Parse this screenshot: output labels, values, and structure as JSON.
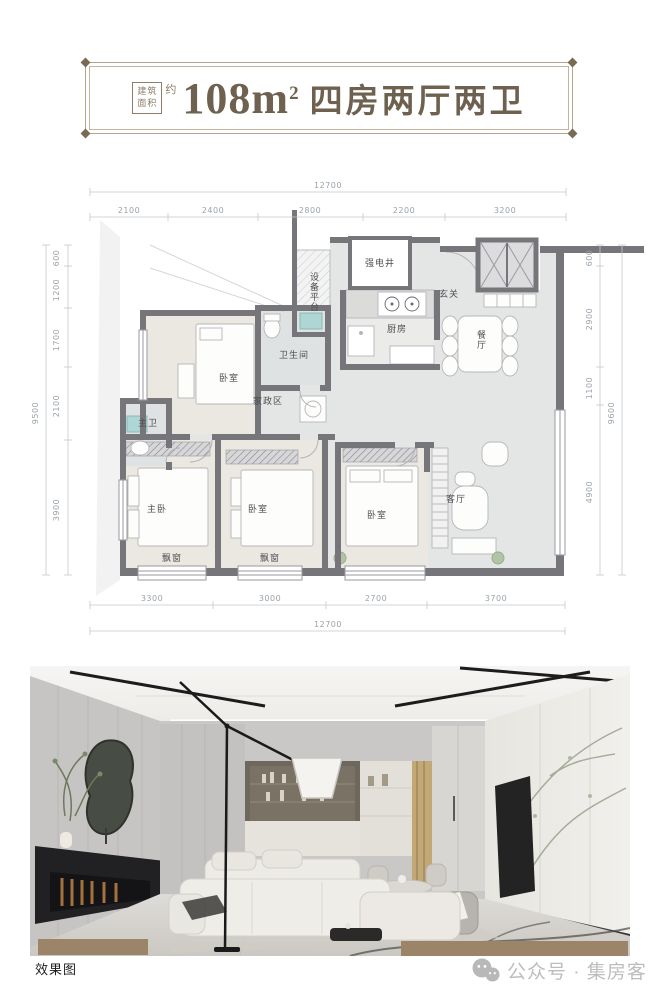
{
  "banner": {
    "area_tag_top": "建筑",
    "area_tag_bottom": "面积",
    "approx": "约",
    "area_value": "108m",
    "area_exponent": "2",
    "title": "四房两厅两卫"
  },
  "plan": {
    "dims": {
      "top_total": "12700",
      "top_segments": [
        "2100",
        "2400",
        "2800",
        "2200",
        "3200"
      ],
      "bottom_total": "12700",
      "bottom_segments": [
        "3300",
        "3000",
        "2700",
        "3700"
      ],
      "left_total": "9500",
      "left_segments": [
        "600",
        "1200",
        "1700",
        "2100",
        "3900"
      ],
      "right_total": "9600",
      "right_segments": [
        "600",
        "2900",
        "1100",
        "4900"
      ]
    },
    "rooms": {
      "shaft": "强电井",
      "platform": "设备平台",
      "entry": "玄关",
      "kitchen": "厨房",
      "dining": "餐厅",
      "bedroom4": "卧室",
      "bathroom": "卫生间",
      "laundry": "家政区",
      "master_bath": "主卫",
      "master_bedroom": "主卧",
      "bedroom2": "卧室",
      "bedroom3": "卧室",
      "living": "客厅",
      "bay_window_left": "飘窗",
      "bay_window_mid": "飘窗"
    }
  },
  "photo": {
    "caption": "效果图"
  },
  "watermark": {
    "label": "公众号 · 集房客"
  },
  "colors": {
    "accent_tan": "#b6a48c",
    "wall": "#75757a",
    "photo_bar": "#9b8468"
  }
}
